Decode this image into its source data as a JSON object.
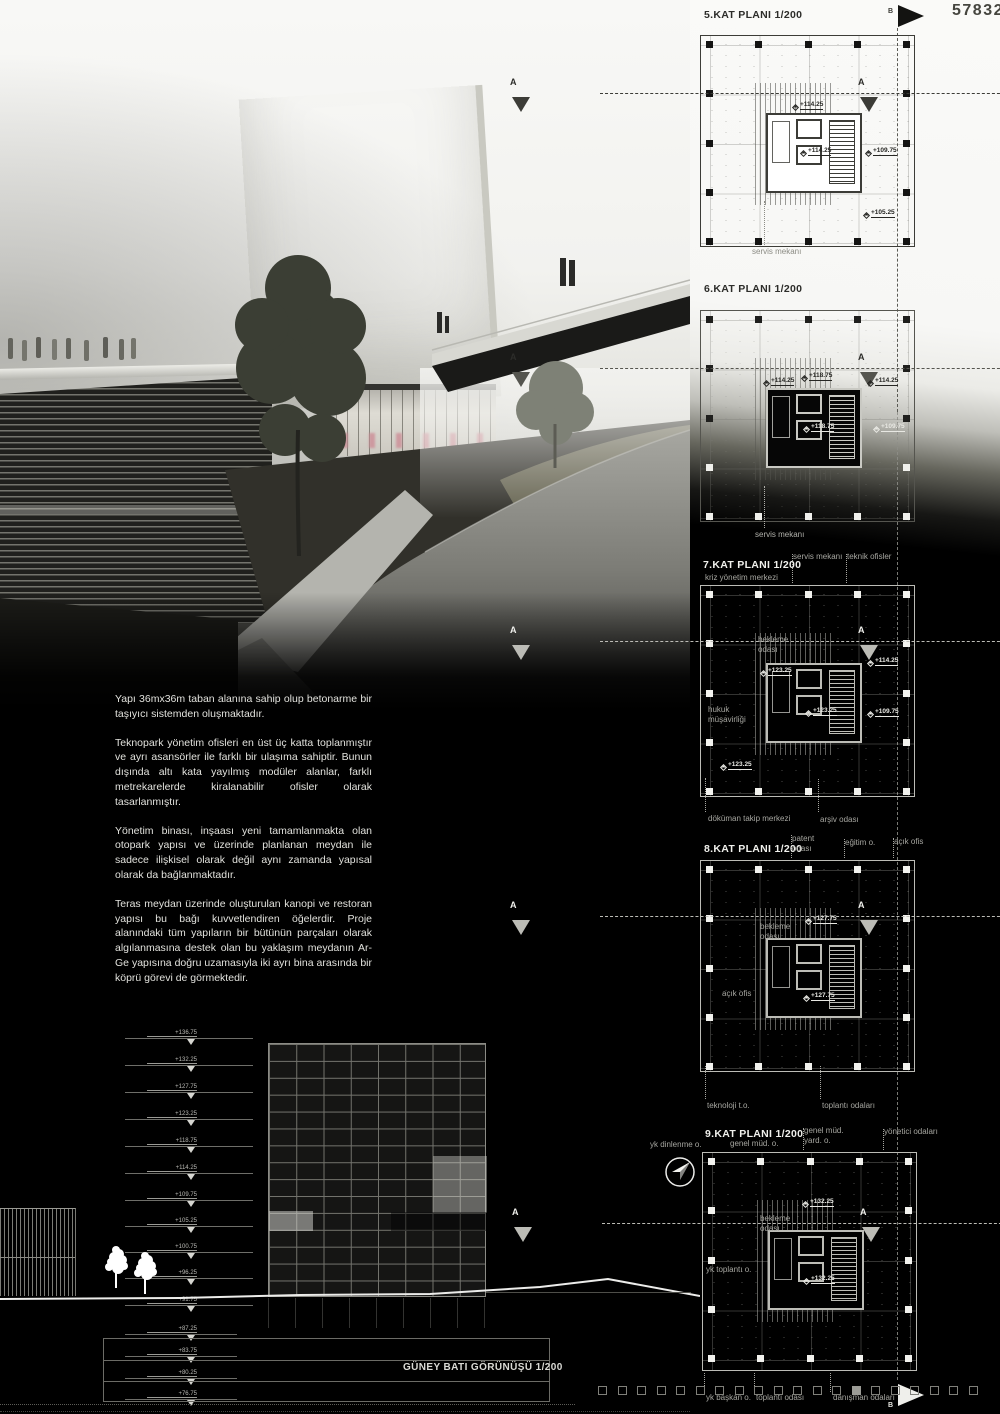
{
  "poster": {
    "entry_number": "57832"
  },
  "markers": {
    "section_a": "A",
    "section_b": "B"
  },
  "narrative": {
    "paragraphs": [
      "Yapı 36mx36m taban alanına sahip olup betonarme bir taşıyıcı sistemden oluşmaktadır.",
      "Teknopark yönetim ofisleri en üst üç katta toplanmıştır ve ayrı asansörler ile farklı bir ulaşıma sahiptir. Bunun dışında altı kata yayılmış modüler alanlar, farklı metrekarelerde kiralanabilir ofisler olarak tasarlanmıştır.",
      "Yönetim binası, inşaası yeni tamamlanmakta olan otopark yapısı ve üzerinde planlanan meydan ile sadece ilişkisel olarak değil aynı zamanda yapısal olarak da bağlanmaktadır.",
      "Teras meydan üzerinde oluşturulan kanopi ve restoran yapısı bu bağı kuvvetlendiren öğelerdir. Proje alanındaki tüm yapıların bir bütünün parçaları olarak algılanmasına destek olan bu yaklaşım meydanın Ar-Ge yapısına doğru uzamasıyla iki ayrı bina arasında bir köprü görevi de görmektedir."
    ]
  },
  "plans": [
    {
      "title": "5.KAT PLANI 1/200",
      "bottom_label": "servis mekanı",
      "levels": [
        "+114.25",
        "+114.25",
        "+109.75",
        "+105.25"
      ]
    },
    {
      "title": "6.KAT PLANI 1/200",
      "bottom_label": "servis mekanı",
      "levels": [
        "+114.25",
        "+118.75",
        "+114.25",
        "+118.75",
        "+109.75"
      ]
    },
    {
      "title": "7.KAT PLANI 1/200",
      "subtitle": "kriz yönetim merkezi",
      "top_labels": [
        "servis mekanı",
        "teknik ofisler"
      ],
      "inside_labels": [
        "bekleme odası",
        "hukuk müşavirliği"
      ],
      "bottom_labels": [
        "döküman takip merkezi",
        "arşiv odası"
      ],
      "levels": [
        "+123.25",
        "+114.25",
        "+123.25",
        "+109.75",
        "+123.25"
      ]
    },
    {
      "title": "8.KAT PLANI 1/200",
      "top_labels": [
        "patent odası",
        "eğitim o.",
        "açık ofis"
      ],
      "inside_labels": [
        "bekleme odası",
        "açık ofis"
      ],
      "bottom_labels": [
        "teknoloji t.o.",
        "toplantı odaları"
      ],
      "levels": [
        "+127.75",
        "+127.75"
      ]
    },
    {
      "title": "9.KAT PLANI 1/200",
      "top_labels": [
        "yk dinlenme o.",
        "genel müd. o.",
        "genel müd. yard. o.",
        "yönetici odaları"
      ],
      "inside_labels": [
        "bekleme odası",
        "yk toplantı o."
      ],
      "bottom_labels": [
        "yk başkan o.",
        "toplantı odası",
        "danışman odaları"
      ],
      "levels": [
        "+132.25",
        "+132.25"
      ]
    }
  ],
  "elevation": {
    "title": "GÜNEY BATI GÖRÜNÜŞÜ 1/200",
    "levels": [
      "+136.75",
      "+132.25",
      "+127.75",
      "+123.25",
      "+118.75",
      "+114.25",
      "+109.75",
      "+105.25",
      "+100.75",
      "+96.25",
      "+91.75",
      "+87.25",
      "+83.75",
      "+80.25",
      "+76.75"
    ]
  }
}
